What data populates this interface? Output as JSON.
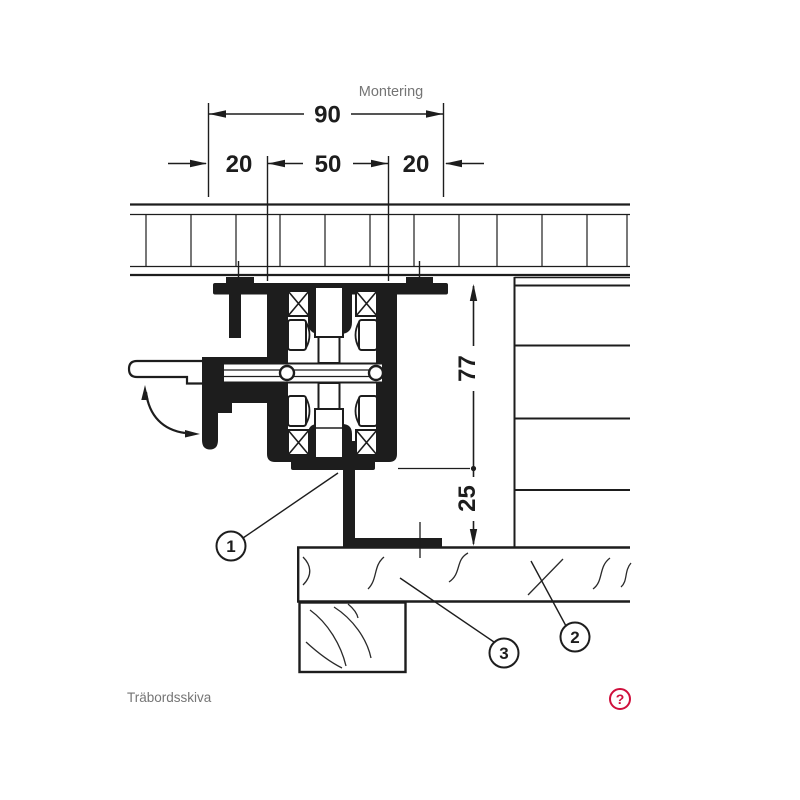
{
  "drawing": {
    "title": "Montering",
    "dimensions": {
      "width_total": "90",
      "width_left": "20",
      "width_center": "50",
      "width_right": "20",
      "height_upper": "77",
      "height_lower": "25"
    },
    "callouts": [
      {
        "id": "1"
      },
      {
        "id": "2"
      },
      {
        "id": "3"
      }
    ],
    "caption": "Träbordsskiva",
    "help": {
      "label": "?"
    },
    "colors": {
      "ink": "#1d1d1d",
      "muted_text": "#757575",
      "accent_red": "#cf0f3c"
    }
  }
}
